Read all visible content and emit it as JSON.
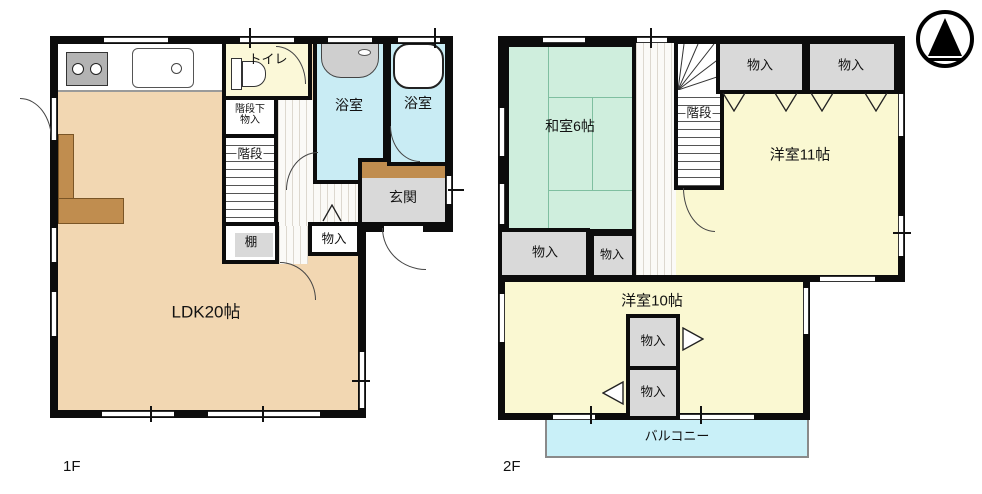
{
  "floor1": {
    "floor_label": "1F",
    "rooms": {
      "ldk": "LDK20帖",
      "toilet": "トイレ",
      "bathroom_left": "浴室",
      "bathroom_right": "浴室",
      "understair_line1": "階段下",
      "understair_line2": "物入",
      "stairs": "階段",
      "entrance": "玄関",
      "shelf": "棚",
      "storage": "物入"
    }
  },
  "floor2": {
    "floor_label": "2F",
    "rooms": {
      "japanese_room": "和室6帖",
      "stairs": "階段",
      "storage_top_left": "物入",
      "storage_top_right": "物入",
      "western_room_11": "洋室11帖",
      "storage_left_outer": "物入",
      "storage_left_inner": "物入",
      "western_room_10": "洋室10帖",
      "storage_mid_upper": "物入",
      "storage_mid_lower": "物入",
      "balcony": "バルコニー"
    }
  },
  "icons": {
    "compass": "north-arrow",
    "kitchen_fixtures": [
      "stove",
      "sink"
    ],
    "bath_fixtures": [
      "washbasin",
      "bathtub"
    ],
    "toilet_fixture": "toilet",
    "door_marks": [
      "swing-arc",
      "folding-chevron",
      "closet-triangle"
    ]
  },
  "colors": {
    "wall": "#0c0c0c",
    "ldk_floor": "#f2d7b2",
    "wood_accent": "#c08d4f",
    "toilet_floor": "#fbf8d8",
    "bathroom_floor": "#c9ecf4",
    "tatami_floor": "#cfeedd",
    "western_floor": "#faf8d2",
    "balcony_floor": "#c9f0f8",
    "storage_gray": "#d9d9d9"
  }
}
